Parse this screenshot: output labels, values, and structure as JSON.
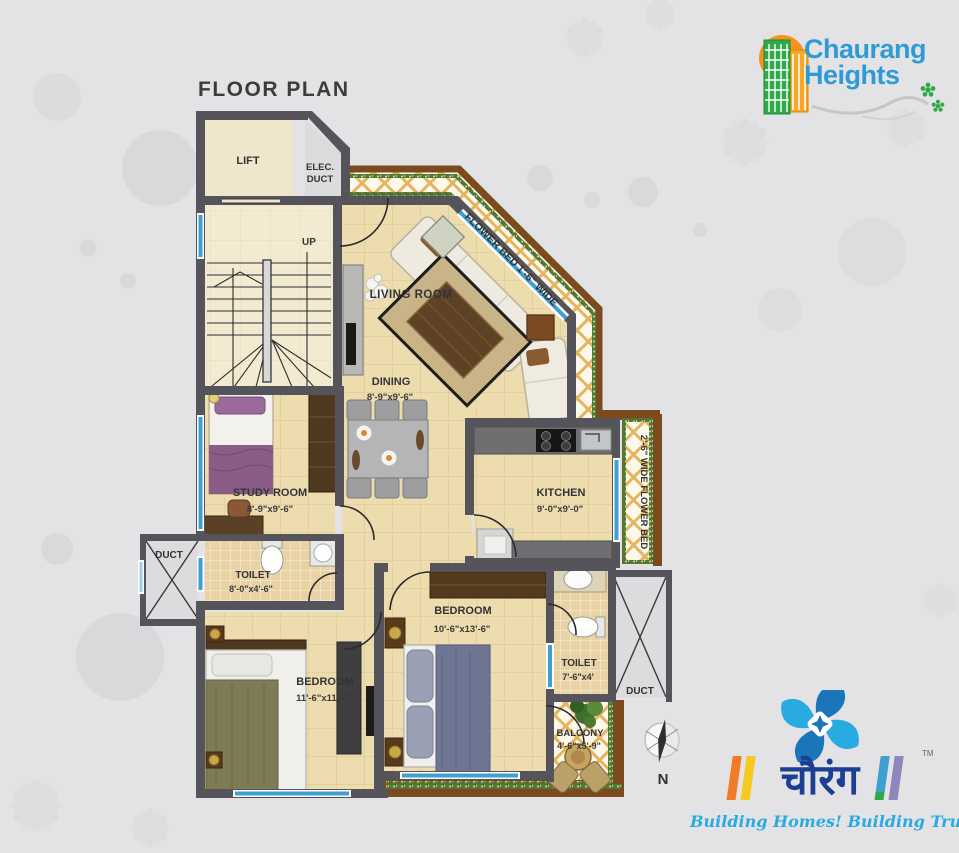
{
  "title": "FLOOR PLAN",
  "logo": {
    "line1": "Chaurang",
    "line2": "Heights"
  },
  "footer_logo": {
    "brand_devanagari": "चौरंग",
    "tm": "TM",
    "tagline": "Building Homes! Building Trust!"
  },
  "compass_label": "N",
  "labels": {
    "lift": "LIFT",
    "elec_line1": "ELEC.",
    "elec_line2": "DUCT",
    "up": "UP",
    "living": "LIVING ROOM",
    "dining": "DINING",
    "dining_dims": "8'-9\"x9'-6\"",
    "study": "STUDY ROOM",
    "study_dims": "8'-9\"x9'-6\"",
    "kitchen": "KITCHEN",
    "kitchen_dims": "9'-0\"x9'-0\"",
    "toilet_left": "TOILET",
    "toilet_left_dims": "8'-0\"x4'-6\"",
    "duct_left": "DUCT",
    "bedroom_right": "BEDROOM",
    "bedroom_right_dims": "10'-6\"x13'-6\"",
    "toilet_right": "TOILET",
    "toilet_right_dims": "7'-6\"x4'",
    "duct_right": "DUCT",
    "bedroom_left": "BEDROOM",
    "bedroom_left_dims": "11'-6\"x11'-6\"",
    "balcony": "BALCONY",
    "balcony_dims": "4'-6\"x5'-9\"",
    "flower_bed_diagonal": "FLOWER BED 1'-6\" WIDE",
    "flower_bed_right": "2'-6\" WIDE FLOWER BED"
  },
  "colors": {
    "wall": "#54545a",
    "floor": "#ecdcae",
    "window_blue": "#3f9fd0",
    "flower_bed_border": "#7b4a1e",
    "brand_blue": "#2e9bd6",
    "brand_dark_blue": "#1b3f94",
    "tagline_blue": "#29abe2"
  }
}
